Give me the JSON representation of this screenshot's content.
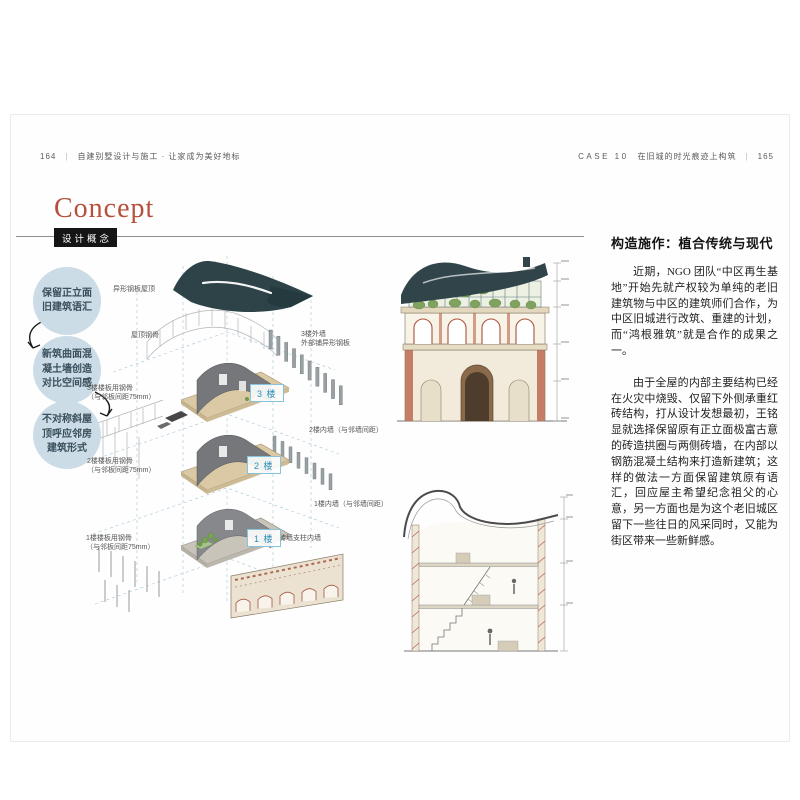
{
  "header_left": {
    "page": "164",
    "divider": "|",
    "title": "自建别墅设计与施工 · 让家成为美好地标"
  },
  "header_right": {
    "case_label": "CASE 10",
    "title": "在旧城的时光痕迹上构筑",
    "divider": "|",
    "page": "165"
  },
  "concept": {
    "title": "Concept",
    "badge": "设计概念"
  },
  "bubbles": [
    "保留正立面旧建筑语汇",
    "新筑曲面混凝土墙创造对比空间感",
    "不对称斜屋顶呼应邻房建筑形式"
  ],
  "icons": {
    "flow_arrow": "curved-arrow"
  },
  "diagram": {
    "roof_plate_label": "异形钢板屋顶",
    "roof_frame_label": "屋顶钢骨",
    "wall_3f_label": "3楼外墙",
    "wall_3f_sublabel": "外部铺异形钢板",
    "slab_3f_label": "3楼楼板用钢骨",
    "slab_3f_sublabel": "（与邻板间距75mm）",
    "wall_2f_label": "2楼内墙（与邻墙间距）",
    "slab_2f_label": "2楼楼板用钢骨",
    "slab_2f_sublabel": "（与邻板间距75mm）",
    "wall_1f_label": "1楼内墙（与邻墙间距）",
    "brick_wall_label": "砖墙支柱内墙",
    "slab_1f_label": "1楼楼板用钢骨",
    "slab_1f_sublabel": "（与邻板间距75mm）",
    "floor_badges": [
      "3 楼",
      "2 楼",
      "1 楼"
    ]
  },
  "article": {
    "title": "构造施作：植合传统与现代",
    "paragraphs": [
      "近期，NGO 团队“中区再生基地”开始先就产权较为单纯的老旧建筑物与中区的建筑师们合作，为中区旧城进行改筑、重建的计划，而“鸿根雅筑”就是合作的成果之一。",
      "由于全屋的内部主要结构已经在火灾中烧毁、仅留下外侧承重红砖结构，打从设计发想最初，王铭显就选择保留原有正立面极富古意的砖造拱圈与两侧砖墙，在内部以钢筋混凝土结构来打造新建筑；这样的做法一方面保留建筑原有语汇，回应屋主希望纪念祖父的心意，另一方面也是为这个老旧城区留下一些往日的风采同时，又能为街区带来一些新鲜感。"
    ]
  },
  "colors": {
    "accent_red": "#b5503c",
    "badge_bg": "#151515",
    "bubble_bg": "#cbdce6",
    "floor_badge_blue": "#2e90b8",
    "roof_teal": "#2d4347",
    "brick_red": "#a2543e",
    "slab_beige": "#d9c8a4",
    "guide_blue": "#9fc3d6"
  }
}
